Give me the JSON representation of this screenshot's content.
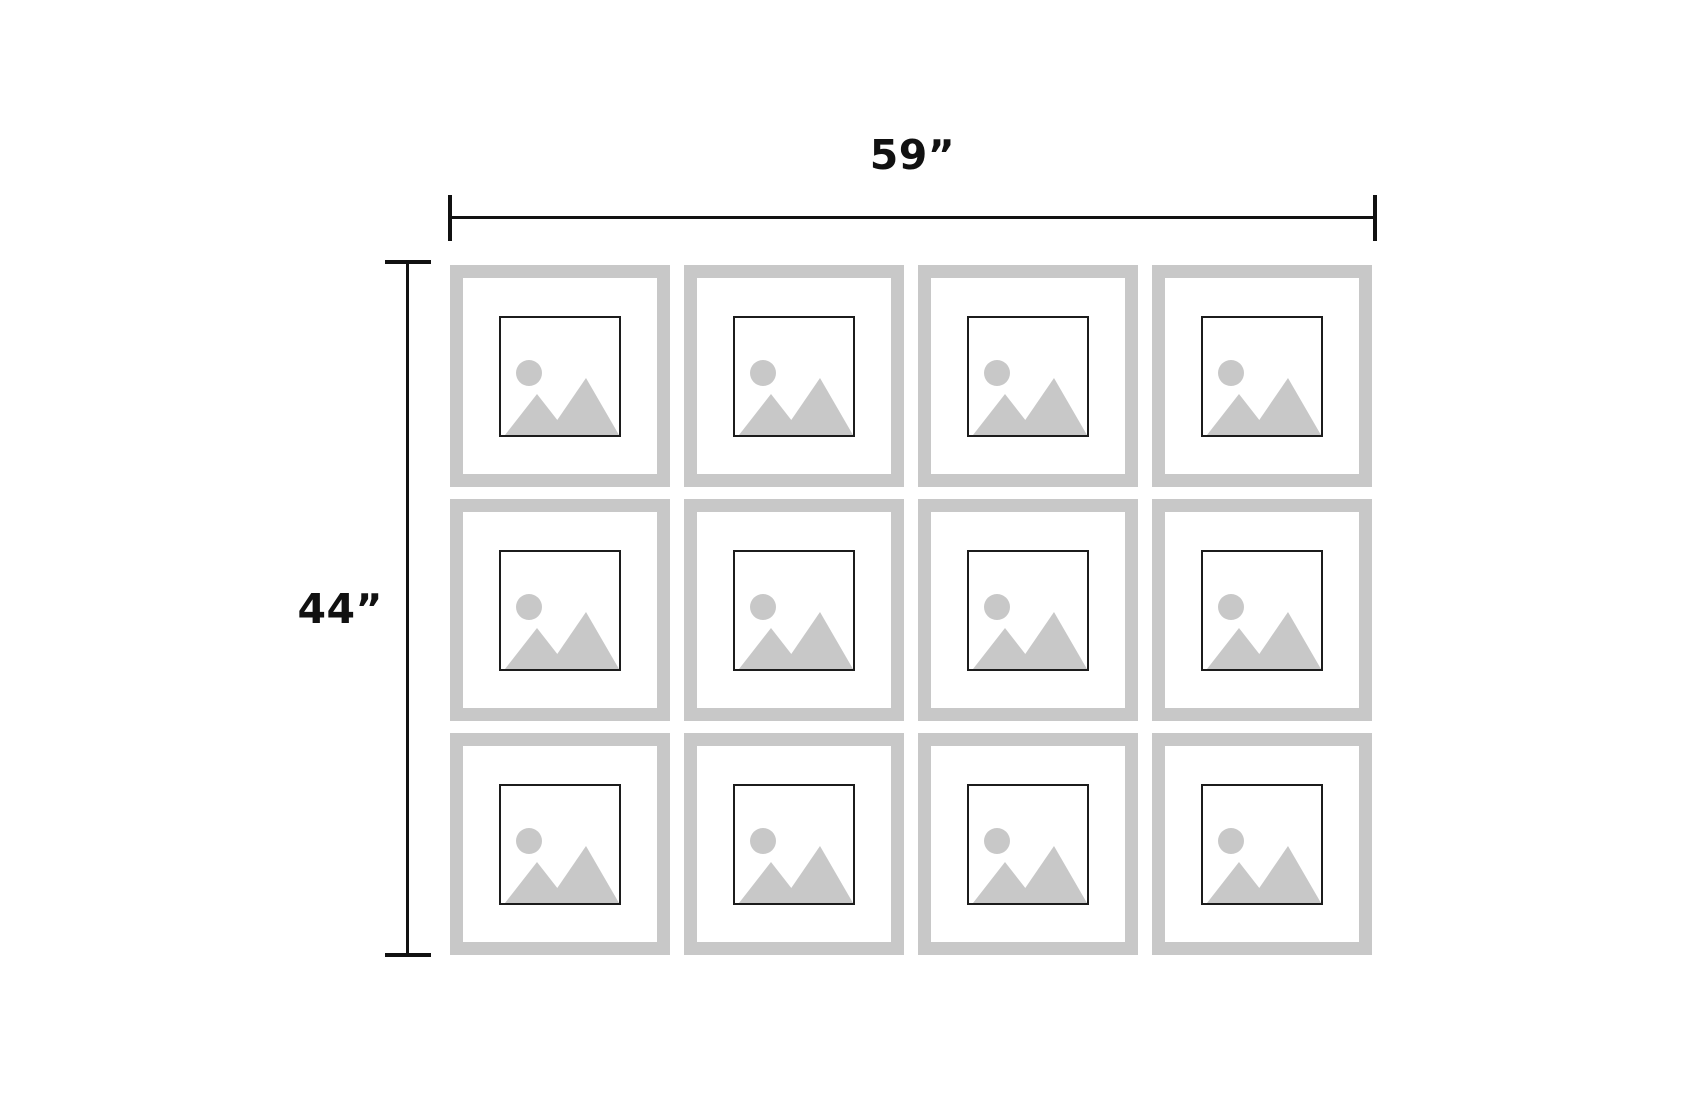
{
  "diagram": {
    "width_label": "59”",
    "height_label": "44”",
    "grid": {
      "columns": 4,
      "rows": 3,
      "frame_count": 12
    }
  },
  "icons": {
    "frame_placeholder": "image-placeholder-icon"
  },
  "colors": {
    "background": "#ffffff",
    "frame_border": "#c8c8c8",
    "matte": "#ffffff",
    "placeholder_art": "#c8c8c8",
    "photo_outline": "#1c1c1c",
    "dimension_line": "#111111",
    "label_text": "#111111"
  }
}
